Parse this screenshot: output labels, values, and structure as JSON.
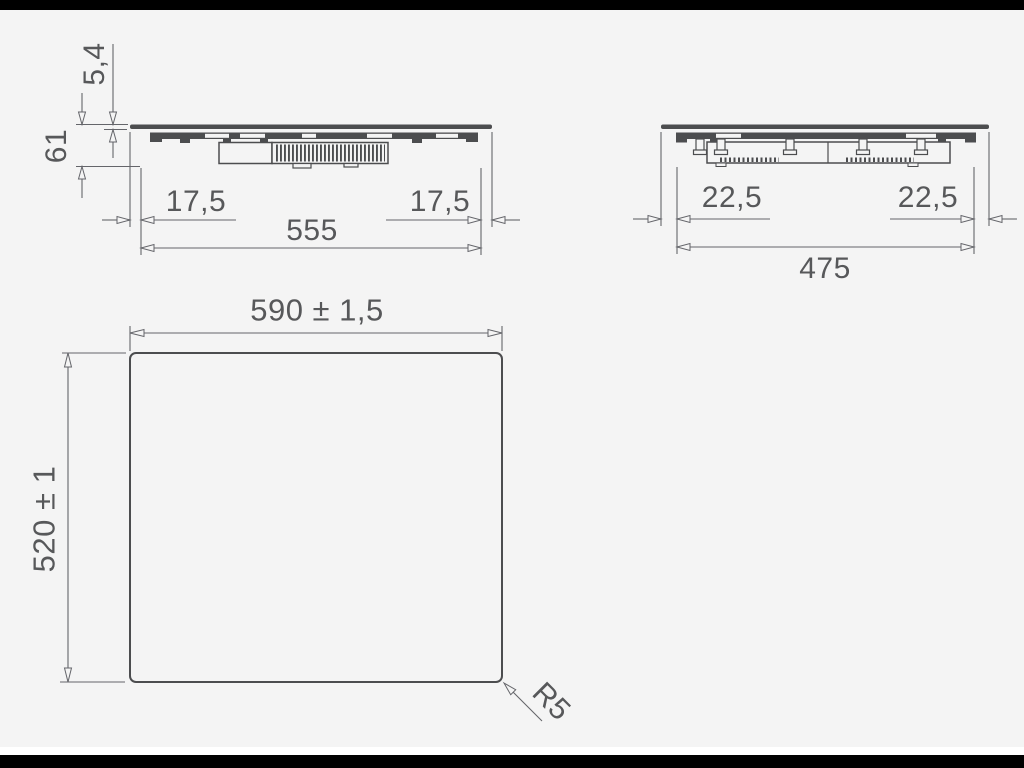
{
  "drawing": {
    "front_view": {
      "glass_thickness": "5,4",
      "total_height": "61",
      "left_overhang": "17,5",
      "right_overhang": "17,5",
      "body_width": "555"
    },
    "side_view": {
      "left_overhang": "22,5",
      "right_overhang": "22,5",
      "body_depth": "475"
    },
    "top_view": {
      "width": "590 ± 1,5",
      "depth": "520 ± 1",
      "corner_radius": "R5"
    }
  },
  "colors": {
    "background": "#f4f4f4",
    "letterbox": "#000000",
    "white_strip": "#ffffff",
    "profile_line": "#4c4d4f",
    "dimension_line": "#64656a",
    "text": "#57585a"
  }
}
